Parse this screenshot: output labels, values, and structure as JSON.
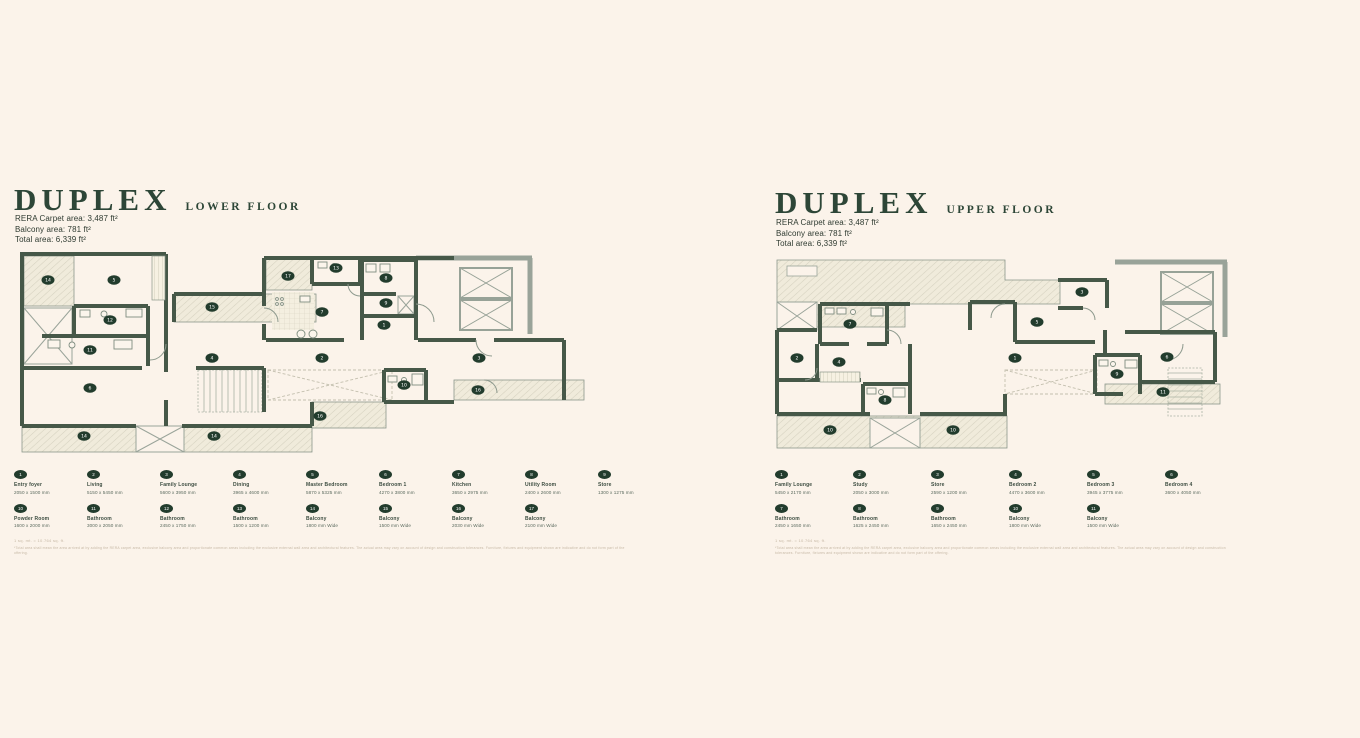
{
  "colors": {
    "background": "#fbf3ea",
    "wall": "#465848",
    "wall_light": "#99a399",
    "accent_green": "#2d4637",
    "marker": "#223c2d",
    "hatch_fill": "#f0ebdb",
    "hatch_line": "#d5d1bf"
  },
  "panels": [
    {
      "title": "DUPLEX",
      "subtitle": "LOWER FLOOR",
      "areas": [
        "RERA Carpet area: 3,487 ft²",
        "Balcony area: 781 ft²",
        "Total area: 6,339 ft²"
      ],
      "fineprint_title": "1 sq. mt. = 10.764 sq. ft.",
      "fineprint_body": "*Total area shall mean the area arrived at by adding the RERA carpet area, exclusive balcony area and proportionate common areas including the exclusive external wall area and architectural features. The actual area may vary on account of design and construction tolerances. Furniture, fixtures and equipment shown are indicative and do not form part of the offering.",
      "legend_rows": [
        [
          {
            "num": "1",
            "name": "Entry foyer",
            "dims": "2050 x 1500 mm"
          },
          {
            "num": "2",
            "name": "Living",
            "dims": "5150 x 5450 mm"
          },
          {
            "num": "3",
            "name": "Family Lounge",
            "dims": "5600 x 3950 mm"
          },
          {
            "num": "4",
            "name": "Dining",
            "dims": "3965 x 4600 mm"
          },
          {
            "num": "5",
            "name": "Master Bedroom",
            "dims": "5870 x 5325 mm"
          },
          {
            "num": "6",
            "name": "Bedroom 1",
            "dims": "4270 x 3800 mm"
          },
          {
            "num": "7",
            "name": "Kitchen",
            "dims": "3650 x 2975 mm"
          },
          {
            "num": "8",
            "name": "Utility Room",
            "dims": "2400 x 2600 mm"
          },
          {
            "num": "9",
            "name": "Store",
            "dims": "1300 x 1275 mm"
          }
        ],
        [
          {
            "num": "10",
            "name": "Powder Room",
            "dims": "1600 x 2000 mm"
          },
          {
            "num": "11",
            "name": "Bathroom",
            "dims": "3000 x 2050 mm"
          },
          {
            "num": "12",
            "name": "Bathroom",
            "dims": "2450 x 1750 mm"
          },
          {
            "num": "13",
            "name": "Bathroom",
            "dims": "1500 x 1200 mm"
          },
          {
            "num": "14",
            "name": "Balcony",
            "dims": "1800 mm Wide"
          },
          {
            "num": "15",
            "name": "Balcony",
            "dims": "1500 mm Wide"
          },
          {
            "num": "16",
            "name": "Balcony",
            "dims": "2030 mm Wide"
          },
          {
            "num": "17",
            "name": "Balcony",
            "dims": "2100 mm Wide"
          }
        ]
      ],
      "plan_markers": [
        {
          "x": 34,
          "y": 32,
          "label": "14"
        },
        {
          "x": 100,
          "y": 32,
          "label": "5"
        },
        {
          "x": 96,
          "y": 72,
          "label": "12"
        },
        {
          "x": 76,
          "y": 102,
          "label": "11"
        },
        {
          "x": 76,
          "y": 140,
          "label": "6"
        },
        {
          "x": 70,
          "y": 188,
          "label": "14"
        },
        {
          "x": 200,
          "y": 188,
          "label": "14"
        },
        {
          "x": 198,
          "y": 59,
          "label": "15"
        },
        {
          "x": 274,
          "y": 28,
          "label": "17"
        },
        {
          "x": 322,
          "y": 20,
          "label": "13"
        },
        {
          "x": 308,
          "y": 64,
          "label": "7"
        },
        {
          "x": 372,
          "y": 30,
          "label": "8"
        },
        {
          "x": 372,
          "y": 55,
          "label": "9"
        },
        {
          "x": 370,
          "y": 77,
          "label": "1"
        },
        {
          "x": 198,
          "y": 110,
          "label": "4"
        },
        {
          "x": 308,
          "y": 110,
          "label": "2"
        },
        {
          "x": 465,
          "y": 110,
          "label": "3"
        },
        {
          "x": 390,
          "y": 137,
          "label": "10"
        },
        {
          "x": 464,
          "y": 142,
          "label": "16"
        },
        {
          "x": 306,
          "y": 168,
          "label": "16"
        }
      ]
    },
    {
      "title": "DUPLEX",
      "subtitle": "UPPER FLOOR",
      "areas": [
        "RERA Carpet area: 3,487 ft²",
        "Balcony area: 781 ft²",
        "Total area: 6,339 ft²"
      ],
      "fineprint_title": "1 sq. mt. = 10.764 sq. ft.",
      "fineprint_body": "*Total area shall mean the area arrived at by adding the RERA carpet area, exclusive balcony area and proportionate common areas including the exclusive external wall area and architectural features. The actual area may vary on account of design and construction tolerances. Furniture, fixtures and equipment shown are indicative and do not form part of the offering.",
      "legend_rows": [
        [
          {
            "num": "1",
            "name": "Family Lounge",
            "dims": "5450 x 2170 mm"
          },
          {
            "num": "2",
            "name": "Study",
            "dims": "2050 x 3000 mm"
          },
          {
            "num": "3",
            "name": "Store",
            "dims": "2590 x 1200 mm"
          },
          {
            "num": "4",
            "name": "Bedroom 2",
            "dims": "4470 x 3600 mm"
          },
          {
            "num": "5",
            "name": "Bedroom 3",
            "dims": "3945 x 3775 mm"
          },
          {
            "num": "6",
            "name": "Bedroom 4",
            "dims": "3600 x 4050 mm"
          }
        ],
        [
          {
            "num": "7",
            "name": "Bathroom",
            "dims": "2450 x 1650 mm"
          },
          {
            "num": "8",
            "name": "Bathroom",
            "dims": "1625 x 2450 mm"
          },
          {
            "num": "9",
            "name": "Bathroom",
            "dims": "1650 x 2450 mm"
          },
          {
            "num": "10",
            "name": "Balcony",
            "dims": "1800 mm Wide"
          },
          {
            "num": "11",
            "name": "Balcony",
            "dims": "1500 mm Wide"
          }
        ]
      ],
      "plan_markers": [
        {
          "x": 75,
          "y": 72,
          "label": "7"
        },
        {
          "x": 22,
          "y": 106,
          "label": "2"
        },
        {
          "x": 64,
          "y": 110,
          "label": "4"
        },
        {
          "x": 110,
          "y": 148,
          "label": "8"
        },
        {
          "x": 55,
          "y": 178,
          "label": "10"
        },
        {
          "x": 178,
          "y": 178,
          "label": "10"
        },
        {
          "x": 240,
          "y": 106,
          "label": "1"
        },
        {
          "x": 262,
          "y": 70,
          "label": "5"
        },
        {
          "x": 307,
          "y": 40,
          "label": "3"
        },
        {
          "x": 392,
          "y": 105,
          "label": "6"
        },
        {
          "x": 342,
          "y": 122,
          "label": "9"
        },
        {
          "x": 388,
          "y": 140,
          "label": "11"
        }
      ]
    }
  ]
}
